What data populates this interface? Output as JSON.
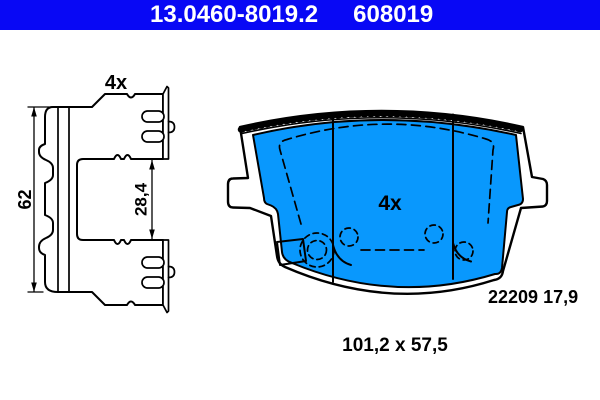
{
  "header": {
    "part_number": "13.0460-8019.2",
    "reference_number": "608019",
    "bg_color": "#0808f5",
    "text_color": "#ffffff"
  },
  "accessory_drawing": {
    "quantity_label": "4x",
    "height_dim": "62",
    "gap_dim": "28,4"
  },
  "pad_drawing": {
    "quantity_label": "4x",
    "fill_color": "#0998fd",
    "part_code": "22209",
    "thickness": "17,9"
  },
  "footer": {
    "overall_dimensions": "101,2 x 57,5"
  }
}
